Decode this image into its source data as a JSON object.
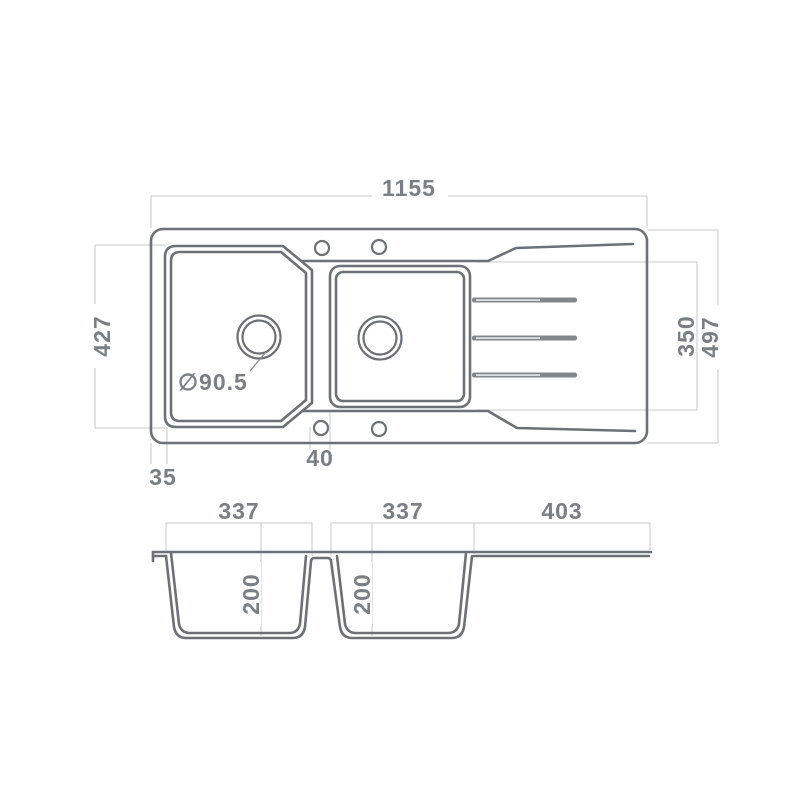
{
  "colors": {
    "line": "#6d7175",
    "dim_line": "#c8cacc",
    "text": "#7b7f83",
    "rib_fill": "#83878a",
    "background": "#ffffff"
  },
  "top_view": {
    "overall_width_label": "1155",
    "bowl_depth_label": "427",
    "drainer_depth_label": "350",
    "overall_depth_label": "497",
    "left_edge_offset_label": "35",
    "divider_width_label": "40",
    "drain_diameter_label": "∅90.5"
  },
  "section_view": {
    "bowl1_width_label": "337",
    "bowl2_width_label": "337",
    "drainer_width_label": "403",
    "bowl1_depth_label": "200",
    "bowl2_depth_label": "200"
  }
}
